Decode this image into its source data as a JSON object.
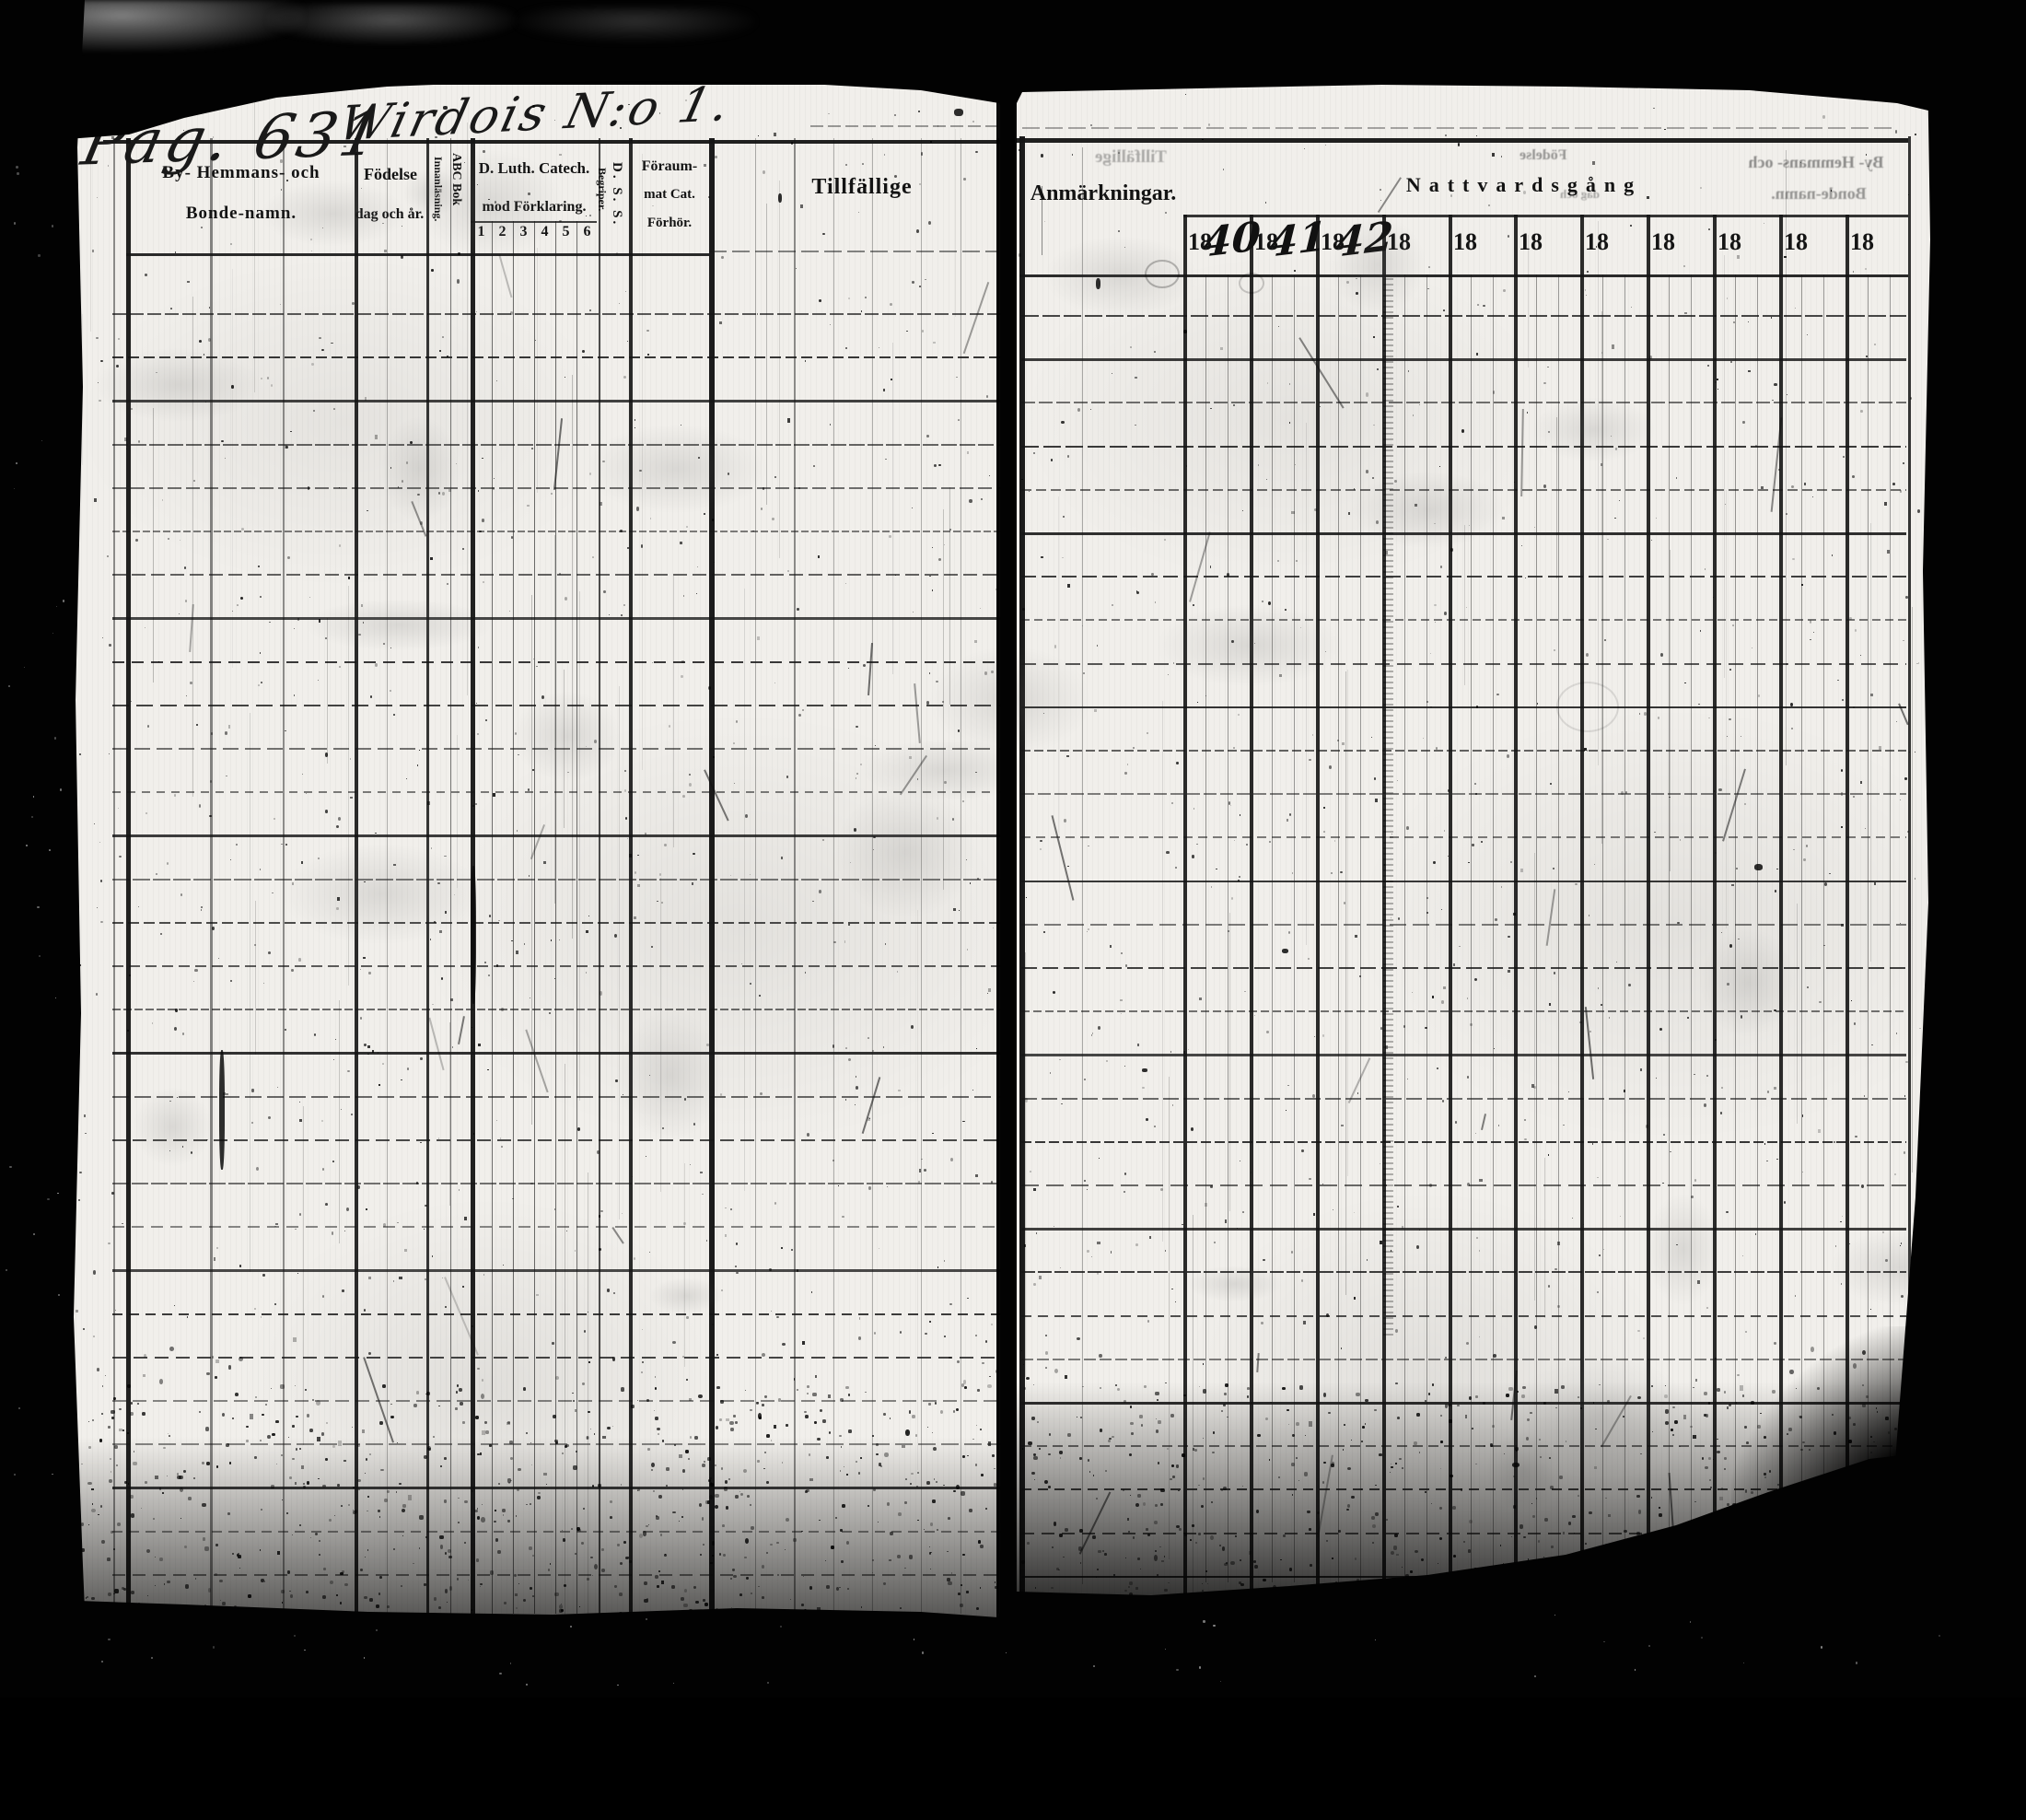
{
  "handwritten": {
    "page_label": "Pag. 631",
    "place_label": "Wirdois N:o 1."
  },
  "left_page": {
    "col_name_line1": "By- Hemmans- och",
    "col_name_line2": "Bonde-namn.",
    "col_birth_line1": "Födelse",
    "col_birth_line2": "dag och år.",
    "col_abc_line1": "ABC Bok",
    "col_abc_line2": "Innanläsning.",
    "col_catech_line1": "D. Luth. Catech.",
    "col_catech_line2": "mod Förklaring.",
    "catech_numbers": [
      "1",
      "2",
      "3",
      "4",
      "5",
      "6"
    ],
    "col_dss_line1": "D. S. S.",
    "col_dss_line2": "Begriper.",
    "col_forsummat_line1": "Föraum-",
    "col_forsummat_line2": "mat Cat.",
    "col_forsummat_line3": "Förhör.",
    "col_tillfallige": "Tillfällige"
  },
  "right_page": {
    "col_anmarkningar": "Anmärkningar.",
    "nattvardsgang_header": "Nattvardsgång",
    "year_cells": [
      {
        "printed": "18",
        "written": "40"
      },
      {
        "printed": "18",
        "written": "41"
      },
      {
        "printed": "18",
        "written": "42"
      },
      {
        "printed": "18",
        "written": ""
      },
      {
        "printed": "18",
        "written": ""
      },
      {
        "printed": "18",
        "written": ""
      },
      {
        "printed": "18",
        "written": ""
      },
      {
        "printed": "18",
        "written": ""
      },
      {
        "printed": "18",
        "written": ""
      },
      {
        "printed": "18",
        "written": ""
      },
      {
        "printed": "18",
        "written": ""
      }
    ]
  },
  "bleedthrough": {
    "tillfallige": "Tillfällige",
    "fodelse": "Födelse",
    "dag_och": "dag och",
    "by_hemmans": "By- Hemmans- och",
    "bonde_namn": "Bonde-namn."
  },
  "colors": {
    "film_black": "#020202",
    "paper_white": "#f1efeb",
    "ink_black": "#131313"
  }
}
